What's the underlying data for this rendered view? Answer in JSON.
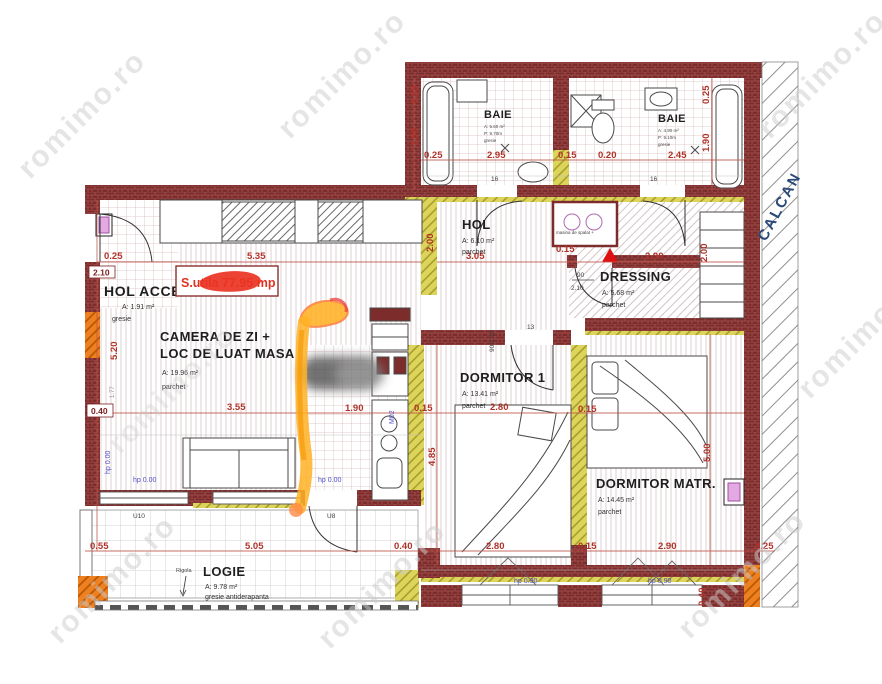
{
  "watermark": {
    "text": "romimo.ro"
  },
  "summary": {
    "label": "S.utila 77.95 mp"
  },
  "rooms": {
    "baie1": {
      "name": "BAIE",
      "area": "A: 5.60 m²",
      "perimeter": "P: 9.70m",
      "floor": "gresie"
    },
    "baie2": {
      "name": "BAIE",
      "area": "A: 4.90 m²",
      "perimeter": "P: 9.10m",
      "floor": "gresie"
    },
    "hol": {
      "name": "HOL",
      "area": "A: 6.10 m²",
      "floor": "parchet"
    },
    "hol_acces": {
      "name": "HOL ACCES",
      "area": "A: 1.91 m²",
      "floor": "gresie"
    },
    "dressing": {
      "name": "DRESSING",
      "area": "A: 5.68 m²",
      "floor": "parchet"
    },
    "camera_de_zi": {
      "name_line1": "CAMERA DE ZI +",
      "name_line2": "LOC DE LUAT MASA",
      "area": "A: 19.96 m²",
      "floor": "parchet"
    },
    "dormitor1": {
      "name": "DORMITOR 1",
      "area": "A: 13.41 m²",
      "floor": "parchet"
    },
    "dormitor_matr": {
      "name": "DORMITOR MATR.",
      "area": "A: 14.45 m²",
      "floor": "parchet"
    },
    "logie": {
      "name": "LOGIE",
      "area": "A: 9.78 m²",
      "floor": "gresie antiderapanta"
    }
  },
  "labels": {
    "calcan": "CALCAN",
    "rigola": "Rigola",
    "washer": "masina de spalat +",
    "hp_zero": "hp 0.00",
    "hp_window": "hp 0.90",
    "m02": "M02"
  },
  "doors": {
    "bath1": "16",
    "bath2": "16",
    "hol_bedroom": "13",
    "dressing_w": "90",
    "dressing_h": "2.10",
    "hol_size": "90/2.10",
    "logie_u10": "U10",
    "logie_u8": "U8"
  },
  "dims": {
    "t1": "0.25",
    "t2": "2.95",
    "t3": "0.15",
    "t4": "0.20",
    "t5": "2.45",
    "v_left_190": "1.90",
    "v_left_025": "0.25",
    "v_right_190": "1.90",
    "v_right_025": "0.25",
    "m_025": "0.25",
    "m_210": "2.10",
    "m_535": "5.35",
    "m_305": "3.05",
    "m_015": "0.15",
    "m_290": "2.90",
    "v_200": "2.00",
    "r_200": "2.00",
    "l_520": "5.20",
    "l_040": "0.40",
    "l_177": "1.77",
    "c_355": "3.55",
    "c_190": "1.90",
    "c_015": "0.15",
    "c_280": "2.80",
    "c2_015": "0.15",
    "v_485": "4.85",
    "v_500": "5.00",
    "b_055": "0.55",
    "b_505": "5.05",
    "b_040": "0.40",
    "b_280": "2.80",
    "b_015": "0.15",
    "b_290": "2.90",
    "b_025": "0.25",
    "b2_040": "0.40"
  },
  "colors": {
    "wall_brick": "#7d2c2c",
    "insulation_yellow": "#ddd45a",
    "accent_orange": "#ef8020",
    "dim_red": "#b03228",
    "marker_orange": "#ffb125",
    "scribble_red": "#ea3323",
    "label_blue": "#5050c8",
    "calcan_blue": "#2a4878"
  }
}
